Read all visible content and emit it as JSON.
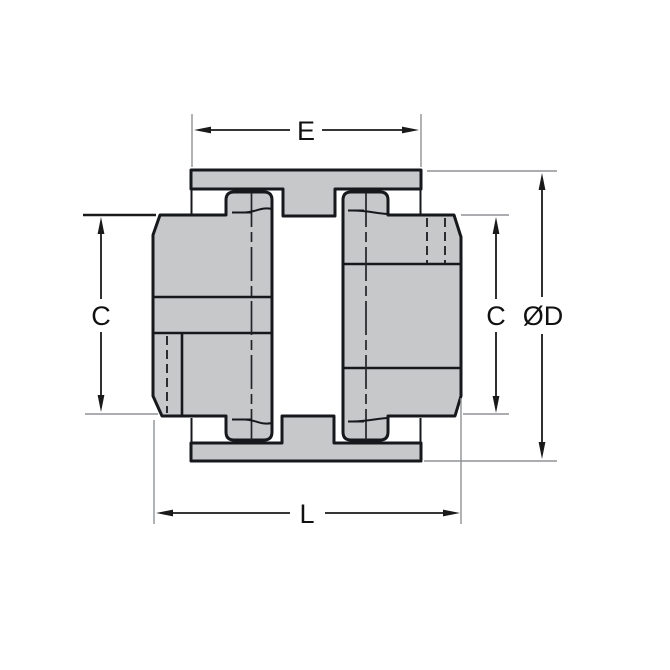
{
  "diagram": {
    "type": "engineering-dimension-drawing",
    "subject": "jaw coupling cross-section, two hubs with center sleeve",
    "dimension_labels": {
      "top_width": "E",
      "left_height": "C",
      "right_height": "C",
      "outer_diameter": "ØD",
      "overall_length": "L"
    },
    "colors": {
      "part_fill": "#c7c8ca",
      "outline": "#16181b",
      "dimension_line": "#1a1a1a",
      "extension_line": "#8f9295",
      "background": "#ffffff"
    }
  }
}
